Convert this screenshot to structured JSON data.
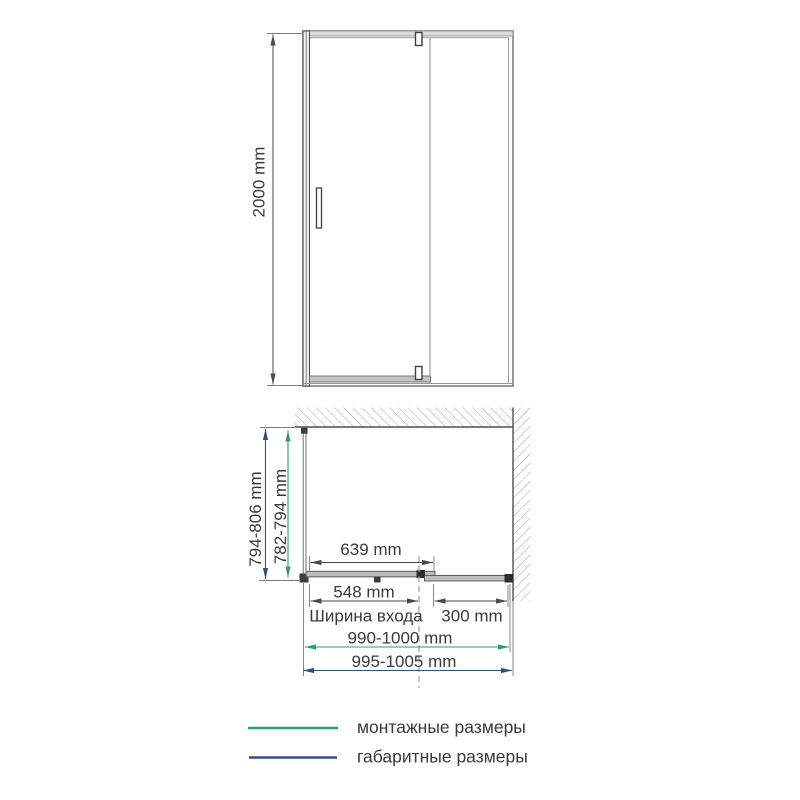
{
  "colors": {
    "mounting_green": "#2a9e74",
    "overall_blue": "#2e4f86"
  },
  "front_view": {
    "height": "2000 mm"
  },
  "plan_view": {
    "door_span": "639 mm",
    "entry_width": "548 mm",
    "entry_caption": "Ширина входа",
    "fixed_width": "300 mm",
    "depth_overall": "794-806 mm",
    "depth_mounting": "782-794 mm",
    "width_mounting": "990-1000 mm",
    "width_overall": "995-1005 mm"
  },
  "legend": {
    "mounting": "монтажные размеры",
    "overall": "габаритные размеры"
  }
}
